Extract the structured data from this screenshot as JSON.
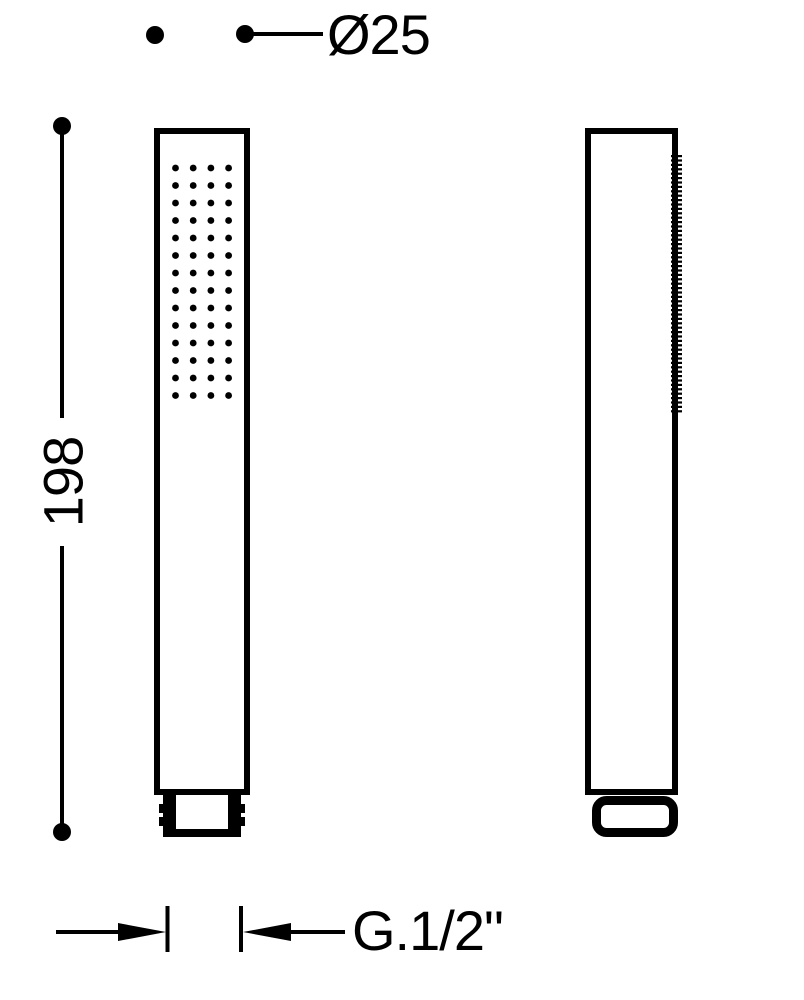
{
  "colors": {
    "ink": "#000000",
    "paper": "#ffffff"
  },
  "dimensions": {
    "diameter_label": "Ø25",
    "length_label": "198",
    "thread_label": "G.1/2\""
  },
  "front_view": {
    "spray_rows": 14,
    "spray_cols": 4
  },
  "side_view": {
    "serration_ticks": 59
  }
}
